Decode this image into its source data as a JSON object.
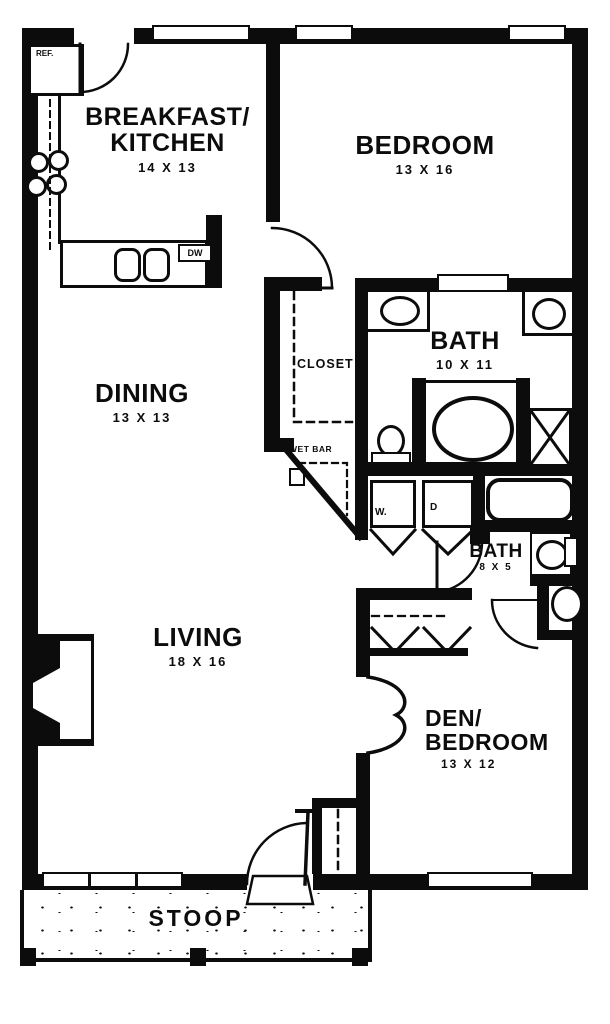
{
  "colors": {
    "ink": "#0c0c0c",
    "paper": "#ffffff"
  },
  "rooms": {
    "kitchen": {
      "name1": "BREAKFAST/",
      "name2": "KITCHEN",
      "dims": "14 X 13"
    },
    "bedroom": {
      "name": "BEDROOM",
      "dims": "13 X 16"
    },
    "bath_master": {
      "name": "BATH",
      "dims": "10 X 11"
    },
    "closet": {
      "name": "CLOSET"
    },
    "dining": {
      "name": "DINING",
      "dims": "13 X 13"
    },
    "wet_bar": {
      "name": "WET BAR"
    },
    "bath_small": {
      "name": "BATH",
      "dims": "8 X 5"
    },
    "living": {
      "name": "LIVING",
      "dims": "18 X 16"
    },
    "den": {
      "name1": "DEN/",
      "name2": "BEDROOM",
      "dims": "13 X 12"
    },
    "stoop": {
      "name": "STOOP"
    }
  },
  "appliances": {
    "refrigerator": "REF.",
    "dishwasher": "DW",
    "washer": "W.",
    "dryer": "D"
  }
}
